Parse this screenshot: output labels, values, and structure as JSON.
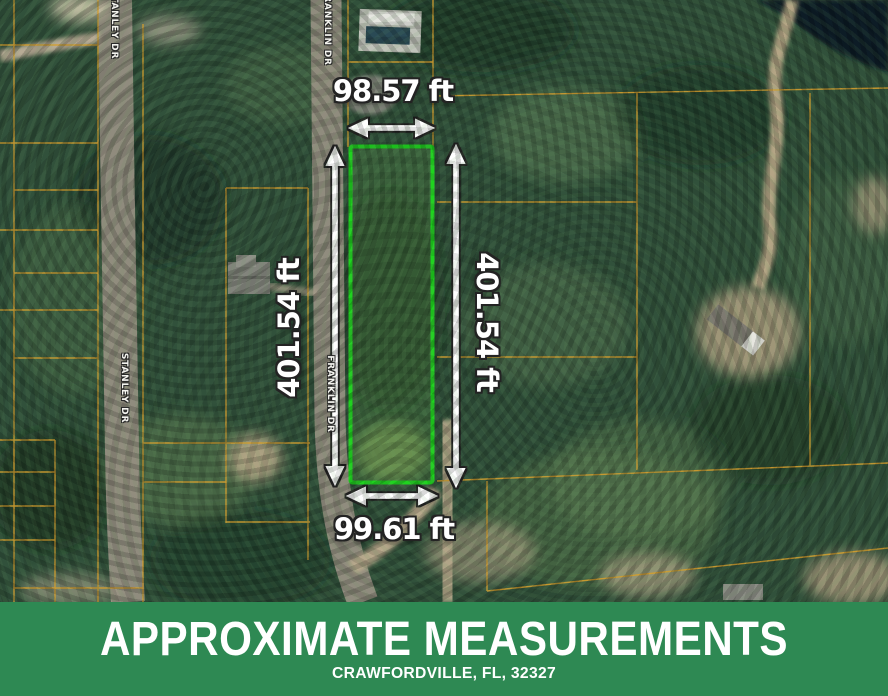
{
  "map": {
    "measurements": {
      "top_width": "98.57 ft",
      "bottom_width": "99.61 ft",
      "left_depth": "401.54 ft",
      "right_depth": "401.54 ft"
    },
    "streets": {
      "stanley_top": "STANLEY DR",
      "stanley_mid": "STANLEY DR",
      "franklin_top": "FRANKLIN DR",
      "franklin_mid": "FRANKLIN DR"
    }
  },
  "banner": {
    "title": "APPROXIMATE MEASUREMENTS",
    "subtitle": "CRAWFORDVILLE, FL, 32327"
  },
  "colors": {
    "banner_green": "#2e8953",
    "parcel_highlight": "#1fd31f",
    "parcel_lines": "#d49e2f",
    "water": "#0b1d27"
  }
}
